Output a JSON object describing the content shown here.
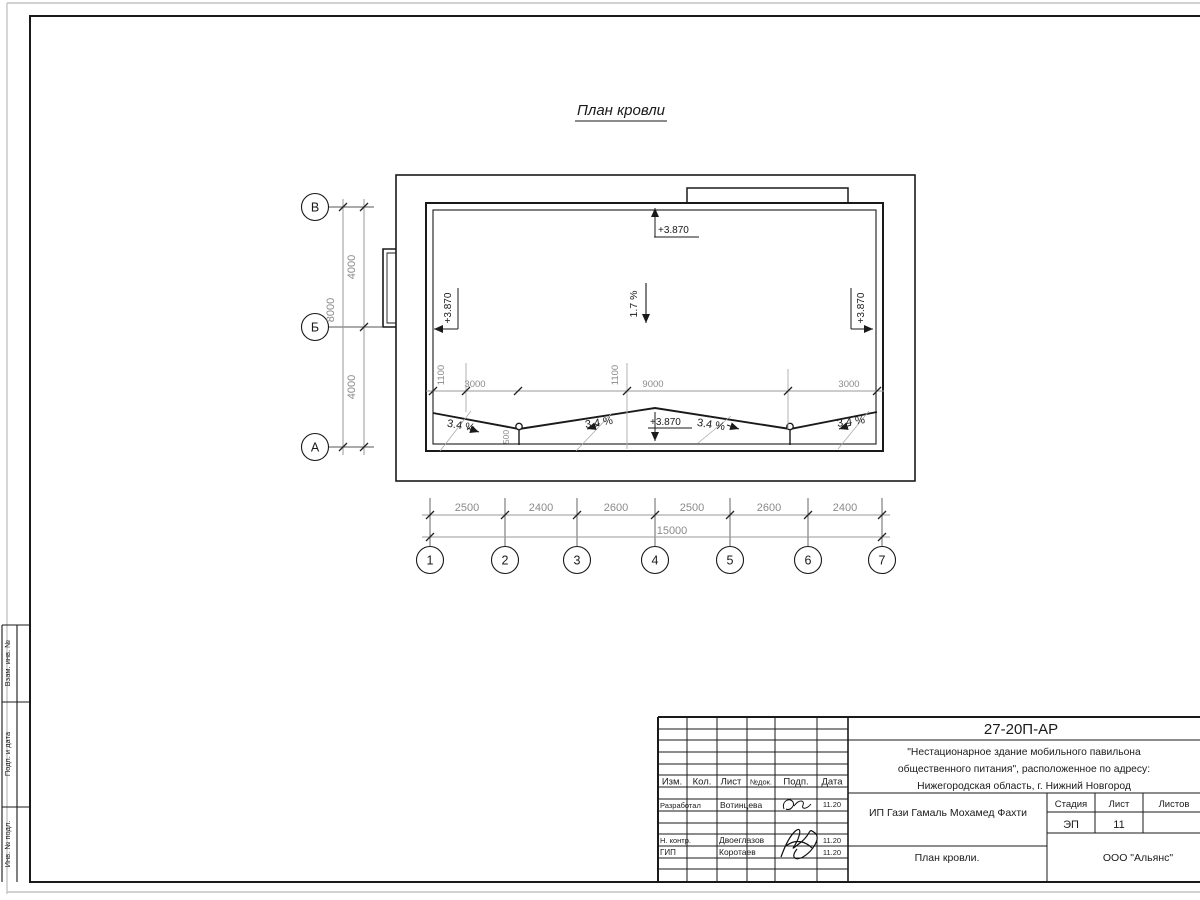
{
  "plan": {
    "title": "План кровли",
    "grid_rows": [
      "В",
      "Б",
      "А"
    ],
    "grid_cols": [
      "1",
      "2",
      "3",
      "4",
      "5",
      "6",
      "7"
    ],
    "dim_left_seg": [
      "4000",
      "4000"
    ],
    "dim_left_total": "8000",
    "dim_bottom_seg": [
      "2500",
      "2400",
      "2600",
      "2500",
      "2600",
      "2400"
    ],
    "dim_bottom_total": "15000",
    "dim_middle": [
      "1100",
      "3000",
      "1100",
      "9000",
      "3000"
    ],
    "dim_drain": "500",
    "elevation": "+3.870",
    "slope_main": "1.7 %",
    "slope_valley": "3.4 %"
  },
  "side_stamp": {
    "cell1": "Взам. инв. №",
    "cell2": "Подп. и дата",
    "cell3": "Инв. № подл."
  },
  "titleblock": {
    "doc_number": "27-20П-АР",
    "project_line1": "\"Нестационарное здание мобильного павильона",
    "project_line2": "общественного питания\", расположенное по адресу:",
    "project_line3": "Нижегородская область, г. Нижний Новгород",
    "client": "ИП Гази Гамаль Мохамед Фахти",
    "sheet_name": "План кровли.",
    "organization": "ООО \"Альянс\"",
    "header": {
      "izm": "Изм.",
      "kol": "Кол.",
      "list": "Лист",
      "ndok": "№док.",
      "podp": "Подп.",
      "data": "Дата"
    },
    "stage_label": "Стадия",
    "sheet_label": "Лист",
    "sheets_label": "Листов",
    "stage_value": "ЭП",
    "sheet_value": "11",
    "rows": [
      {
        "role": "Разработал",
        "name": "Вотинцева",
        "date": "11.20"
      },
      {
        "role": "Н. контр.",
        "name": "Двоеглазов",
        "date": "11.20"
      },
      {
        "role": "ГИП",
        "name": "Коротаев",
        "date": "11.20"
      }
    ]
  }
}
